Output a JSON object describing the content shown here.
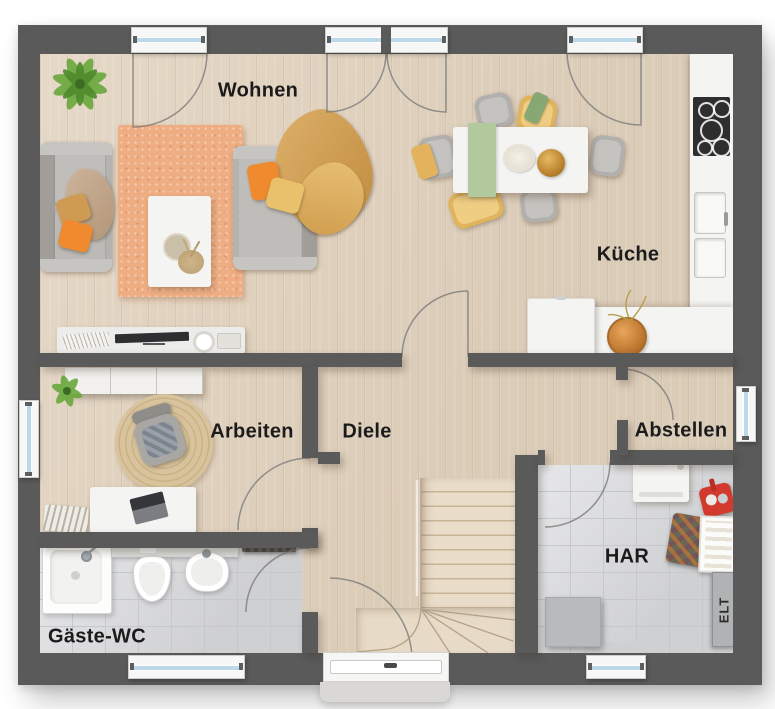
{
  "rooms": [
    {
      "id": "wohnen",
      "label": "Wohnen"
    },
    {
      "id": "kueche",
      "label": "Küche"
    },
    {
      "id": "arbeiten",
      "label": "Arbeiten"
    },
    {
      "id": "diele",
      "label": "Diele"
    },
    {
      "id": "abstellen",
      "label": "Abstellen"
    },
    {
      "id": "har",
      "label": "HAR"
    },
    {
      "id": "gaeste-wc",
      "label": "Gäste-WC"
    }
  ],
  "panel_label": "ELT",
  "colors": {
    "wall": "#5a5a5a",
    "wood-floor": "#e2d3bf",
    "tile-floor": "#d9dadc",
    "tile-grout": "#c6c8cb",
    "counter-white": "#f4f4f2",
    "rug-orange": "#efad83",
    "sofa-grey": "#b5b3b0",
    "pillow-orange": "#ef8a2f",
    "pillow-yellow": "#e9c06c",
    "blanket-tan": "#d2a35f",
    "runner-green": "#b2c99e",
    "plant-green": "#66a33c",
    "window-glass": "#bcd9e9",
    "window-frame": "#f7f7f7",
    "cooktop-black": "#2e2e2e",
    "caddy-red": "#d23a2e",
    "label-text": "#1b1b1b"
  }
}
